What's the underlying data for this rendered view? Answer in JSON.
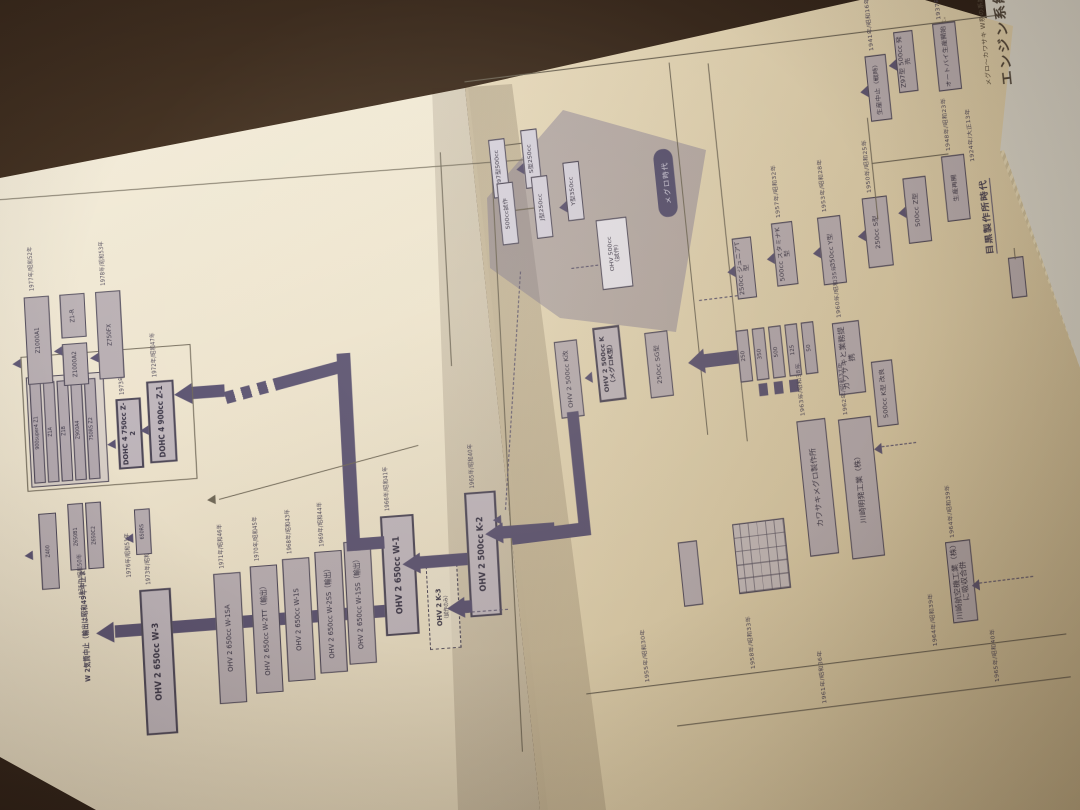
{
  "colors": {
    "table_wood": "#3b2b1e",
    "page_left": "#ece2cb",
    "page_right": "#e7dabc",
    "ink": "#443e50",
    "box_fill": "#b8aeb2",
    "box_border": "#4e4858",
    "thick_line": "#5c5472",
    "purple_tint": "rgba(122,114,148,0.42)",
    "pill_bg": "#575170"
  },
  "title_block": {
    "title": "エンジン系統図",
    "subtitle": "メグロ〜カワサキ W系の系譜",
    "note1": "年代は国内発売年を基準とした。",
    "note2": "（輸出）は輸出専用車を示す。"
  },
  "left_page": {
    "terminal_note": "W 2気筒中止（輸出は昭和49年中止まで）",
    "w_series": [
      {
        "label": "OHV 2 650cc W-3",
        "year": "1973年/昭和48年"
      },
      {
        "label": "OHV 2 650cc W-1SA",
        "year": "1971年/昭和46年"
      },
      {
        "label": "OHV 2 650cc W-2TT（輸出）",
        "year": "1970年/昭和45年"
      },
      {
        "label": "OHV 2 650cc W-1S",
        "year": "1968年/昭和43年"
      },
      {
        "label": "OHV 2 650cc W-2SS（輸出）",
        "year": "1969年/昭和44年"
      },
      {
        "label": "OHV 2 650cc W-1SS（輸出）",
        "year": "1967年/昭和42年"
      },
      {
        "label": "OHV 2 650cc W-1",
        "year": "1966年/昭和41年"
      }
    ],
    "z1_label": "DOHC 4 900cc Z-1",
    "z1_year": "1972年/昭和47年",
    "z2_label": "DOHC 4 750cc Z-2",
    "z2_year": "1973年/昭和48年",
    "z_group": [
      "900super4 Z1",
      "Z1A",
      "Z1B",
      "Z900A4",
      "750RS Z2"
    ],
    "k2_label": "OHV 2 500cc K-2",
    "k2_year": "1965年/昭和40年",
    "k3_label": "OHV 2 K-3",
    "k3_sub": "（試作のみ）",
    "top_boxes": [
      "Z1000A1",
      "Z1-R",
      "Z1000A2",
      "Z750FX"
    ],
    "top_years": [
      "1977年/昭和52年",
      "1978年/昭和53年"
    ],
    "chain_boxes": [
      "Z650B1",
      "Z650C2",
      "Z400",
      "650RS"
    ],
    "chain_years": [
      "1975年/昭和50年",
      "1976年/昭和51年"
    ]
  },
  "right_page": {
    "heading": "目黒製作所時代",
    "heading_year": "1924年/大正13年",
    "pill": "メグロ時代",
    "purple_boxes": [
      "Z97型500cc",
      "500cc試作",
      "S型250cc",
      "J型250cc",
      "Y型350cc"
    ],
    "white_box_l1": "OHV 500cc",
    "white_box_l2": "（試作）",
    "k500_label": "OHV 2 500cc K（メグロK型）",
    "k500kai_label": "OHV 2 500cc K改",
    "boxes": [
      {
        "label": "オートバイ生産開始",
        "year": "1937年/昭和12年"
      },
      {
        "label": "Z97型 500cc 発売",
        "year": ""
      },
      {
        "label": "生産中止（戦時）",
        "year": "1941年/昭和16年"
      },
      {
        "label": "生産再開",
        "year": "1948年/昭和23年"
      },
      {
        "label": "500cc Z型",
        "year": ""
      },
      {
        "label": "250cc S型",
        "year": "1950年/昭和25年"
      },
      {
        "label": "350cc Y型",
        "year": "1953年/昭和28年"
      },
      {
        "label": "500cc スタミナK型",
        "year": "1957年/昭和32年"
      },
      {
        "label": "250cc ジュニアT型",
        "year": ""
      },
      {
        "label": "カワサキと業務提携",
        "year": "1960年/昭和35年"
      },
      {
        "label": "500cc K型 改良",
        "year": ""
      },
      {
        "label": "250cc SG型",
        "year": ""
      }
    ],
    "cluster": [
      "250",
      "350",
      "500",
      "125",
      "50"
    ],
    "long_bars": [
      {
        "label": "カワサキメグロ製作所",
        "year": "1963年/昭和38年"
      },
      {
        "label": "川崎明発工業（株）",
        "year": "1962年/昭和37年"
      }
    ],
    "merge_label": "川崎航空機工業（株）に吸収合併",
    "merge_year": "1964年/昭和39年",
    "timeline_years": [
      "1955年/昭和30年",
      "1958年/昭和33年",
      "1961年/昭和36年",
      "1964年/昭和39年",
      "1965年/昭和40年"
    ]
  }
}
